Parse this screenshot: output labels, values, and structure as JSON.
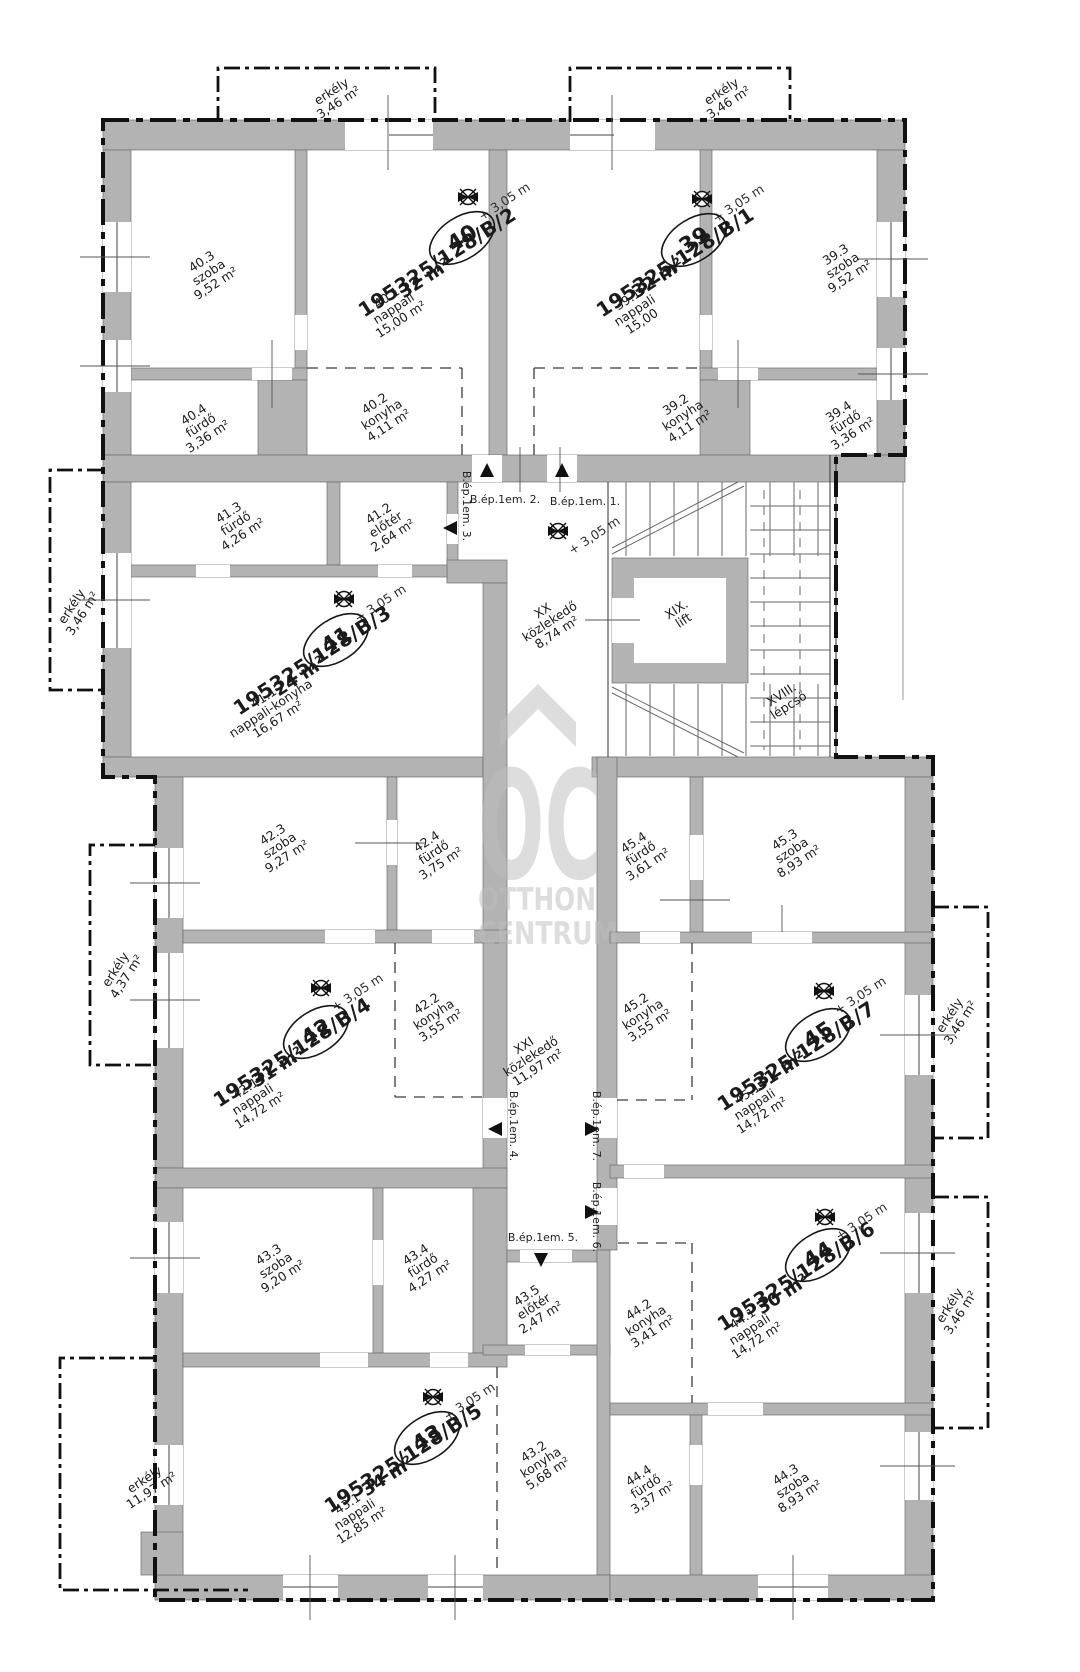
{
  "plan": {
    "level_mark": "+ 3,05 m",
    "apartments": [
      {
        "id": "40",
        "lot": "195325/128/B/2",
        "size": "32 m²",
        "balcony": {
          "name": "erkély",
          "area": "3,46 m²"
        },
        "rooms": [
          {
            "code": "40.1",
            "name": "nappali",
            "area": "15,00 m²"
          },
          {
            "code": "40.2",
            "name": "konyha",
            "area": "4,11 m²"
          },
          {
            "code": "40.3",
            "name": "szoba",
            "area": "9,52 m²"
          },
          {
            "code": "40.4",
            "name": "fürdő",
            "area": "3,36 m²"
          }
        ]
      },
      {
        "id": "39",
        "lot": "195325/128/B/1",
        "size": "32 m²",
        "balcony": {
          "name": "erkély",
          "area": "3,46 m²"
        },
        "rooms": [
          {
            "code": "39.1",
            "name": "nappali",
            "area": "15,00"
          },
          {
            "code": "39.2",
            "name": "konyha",
            "area": "4,11 m²"
          },
          {
            "code": "39.3",
            "name": "szoba",
            "area": "9,52 m²"
          },
          {
            "code": "39.4",
            "name": "fürdő",
            "area": "3,36 m²"
          }
        ]
      },
      {
        "id": "41",
        "lot": "195325/128/B/3",
        "size": "24 m²",
        "balcony": {
          "name": "erkély",
          "area": "3,46 m²"
        },
        "rooms": [
          {
            "code": "41.1",
            "name": "nappali-konyha",
            "area": "16,67 m²"
          },
          {
            "code": "41.2",
            "name": "előtér",
            "area": "2,64 m²"
          },
          {
            "code": "41.3",
            "name": "fürdő",
            "area": "4,26 m²"
          }
        ]
      },
      {
        "id": "42",
        "lot": "195325/128/B/4",
        "size": "31 m²",
        "balcony": {
          "name": "erkély",
          "area": "4,37 m²"
        },
        "rooms": [
          {
            "code": "42.1",
            "name": "nappali",
            "area": "14,72 m²"
          },
          {
            "code": "42.2",
            "name": "konyha",
            "area": "3,55 m²"
          },
          {
            "code": "42.3",
            "name": "szoba",
            "area": "9,27 m²"
          },
          {
            "code": "42.4",
            "name": "fürdő",
            "area": "3,75 m²"
          }
        ]
      },
      {
        "id": "43",
        "lot": "195325/128/B/5",
        "size": "34 m²",
        "balcony": {
          "name": "erkély",
          "area": "11,97 m²"
        },
        "rooms": [
          {
            "code": "43.1",
            "name": "nappali",
            "area": "12,85 m²"
          },
          {
            "code": "43.2",
            "name": "konyha",
            "area": "5,68 m²"
          },
          {
            "code": "43.3",
            "name": "szoba",
            "area": "9,20 m²"
          },
          {
            "code": "43.4",
            "name": "fürdő",
            "area": "4,27 m²"
          },
          {
            "code": "43.5",
            "name": "előtér",
            "area": "2,47 m²"
          }
        ]
      },
      {
        "id": "44",
        "lot": "195325/128/B/6",
        "size": "30 m²",
        "balcony": {
          "name": "erkély",
          "area": "3,46 m²"
        },
        "rooms": [
          {
            "code": "44.1",
            "name": "nappali",
            "area": "14,72 m²"
          },
          {
            "code": "44.2",
            "name": "konyha",
            "area": "3,41 m²"
          },
          {
            "code": "44.3",
            "name": "szoba",
            "area": "8,93 m²"
          },
          {
            "code": "44.4",
            "name": "fürdő",
            "area": "3,37 m²"
          }
        ]
      },
      {
        "id": "45",
        "lot": "195325/128/B/7",
        "size": "31 m²",
        "balcony": {
          "name": "erkély",
          "area": "3,46 m²"
        },
        "rooms": [
          {
            "code": "45.1",
            "name": "nappali",
            "area": "14,72 m²"
          },
          {
            "code": "45.2",
            "name": "konyha",
            "area": "3,55 m²"
          },
          {
            "code": "45.3",
            "name": "szoba",
            "area": "8,93 m²"
          },
          {
            "code": "45.4",
            "name": "fürdő",
            "area": "3,61 m²"
          }
        ]
      }
    ],
    "common_areas": {
      "corridor_upper": {
        "code": "XX",
        "name": "közlekedő",
        "area": "8,74 m²"
      },
      "corridor_lower": {
        "code": "XXI",
        "name": "közlekedő",
        "area": "11,97 m²"
      },
      "lift": {
        "code": "XIX.",
        "name": "lift"
      },
      "stairs": {
        "code": "XVIII.",
        "name": "lépcső"
      }
    },
    "entrances": [
      "B.ép.1em. 1.",
      "B.ép.1em. 2.",
      "B.ép.1em. 3.",
      "B.ép.1em. 4.",
      "B.ép.1em. 5.",
      "B.ép.1em. 6.",
      "B.ép.1em. 7."
    ],
    "watermark": {
      "monogram": "OC",
      "line1": "OTTHON",
      "line2": "CENTRUM"
    },
    "colors": {
      "wall": "#b3b3b3",
      "line": "#111111",
      "watermark": "#bdbdbd"
    }
  }
}
